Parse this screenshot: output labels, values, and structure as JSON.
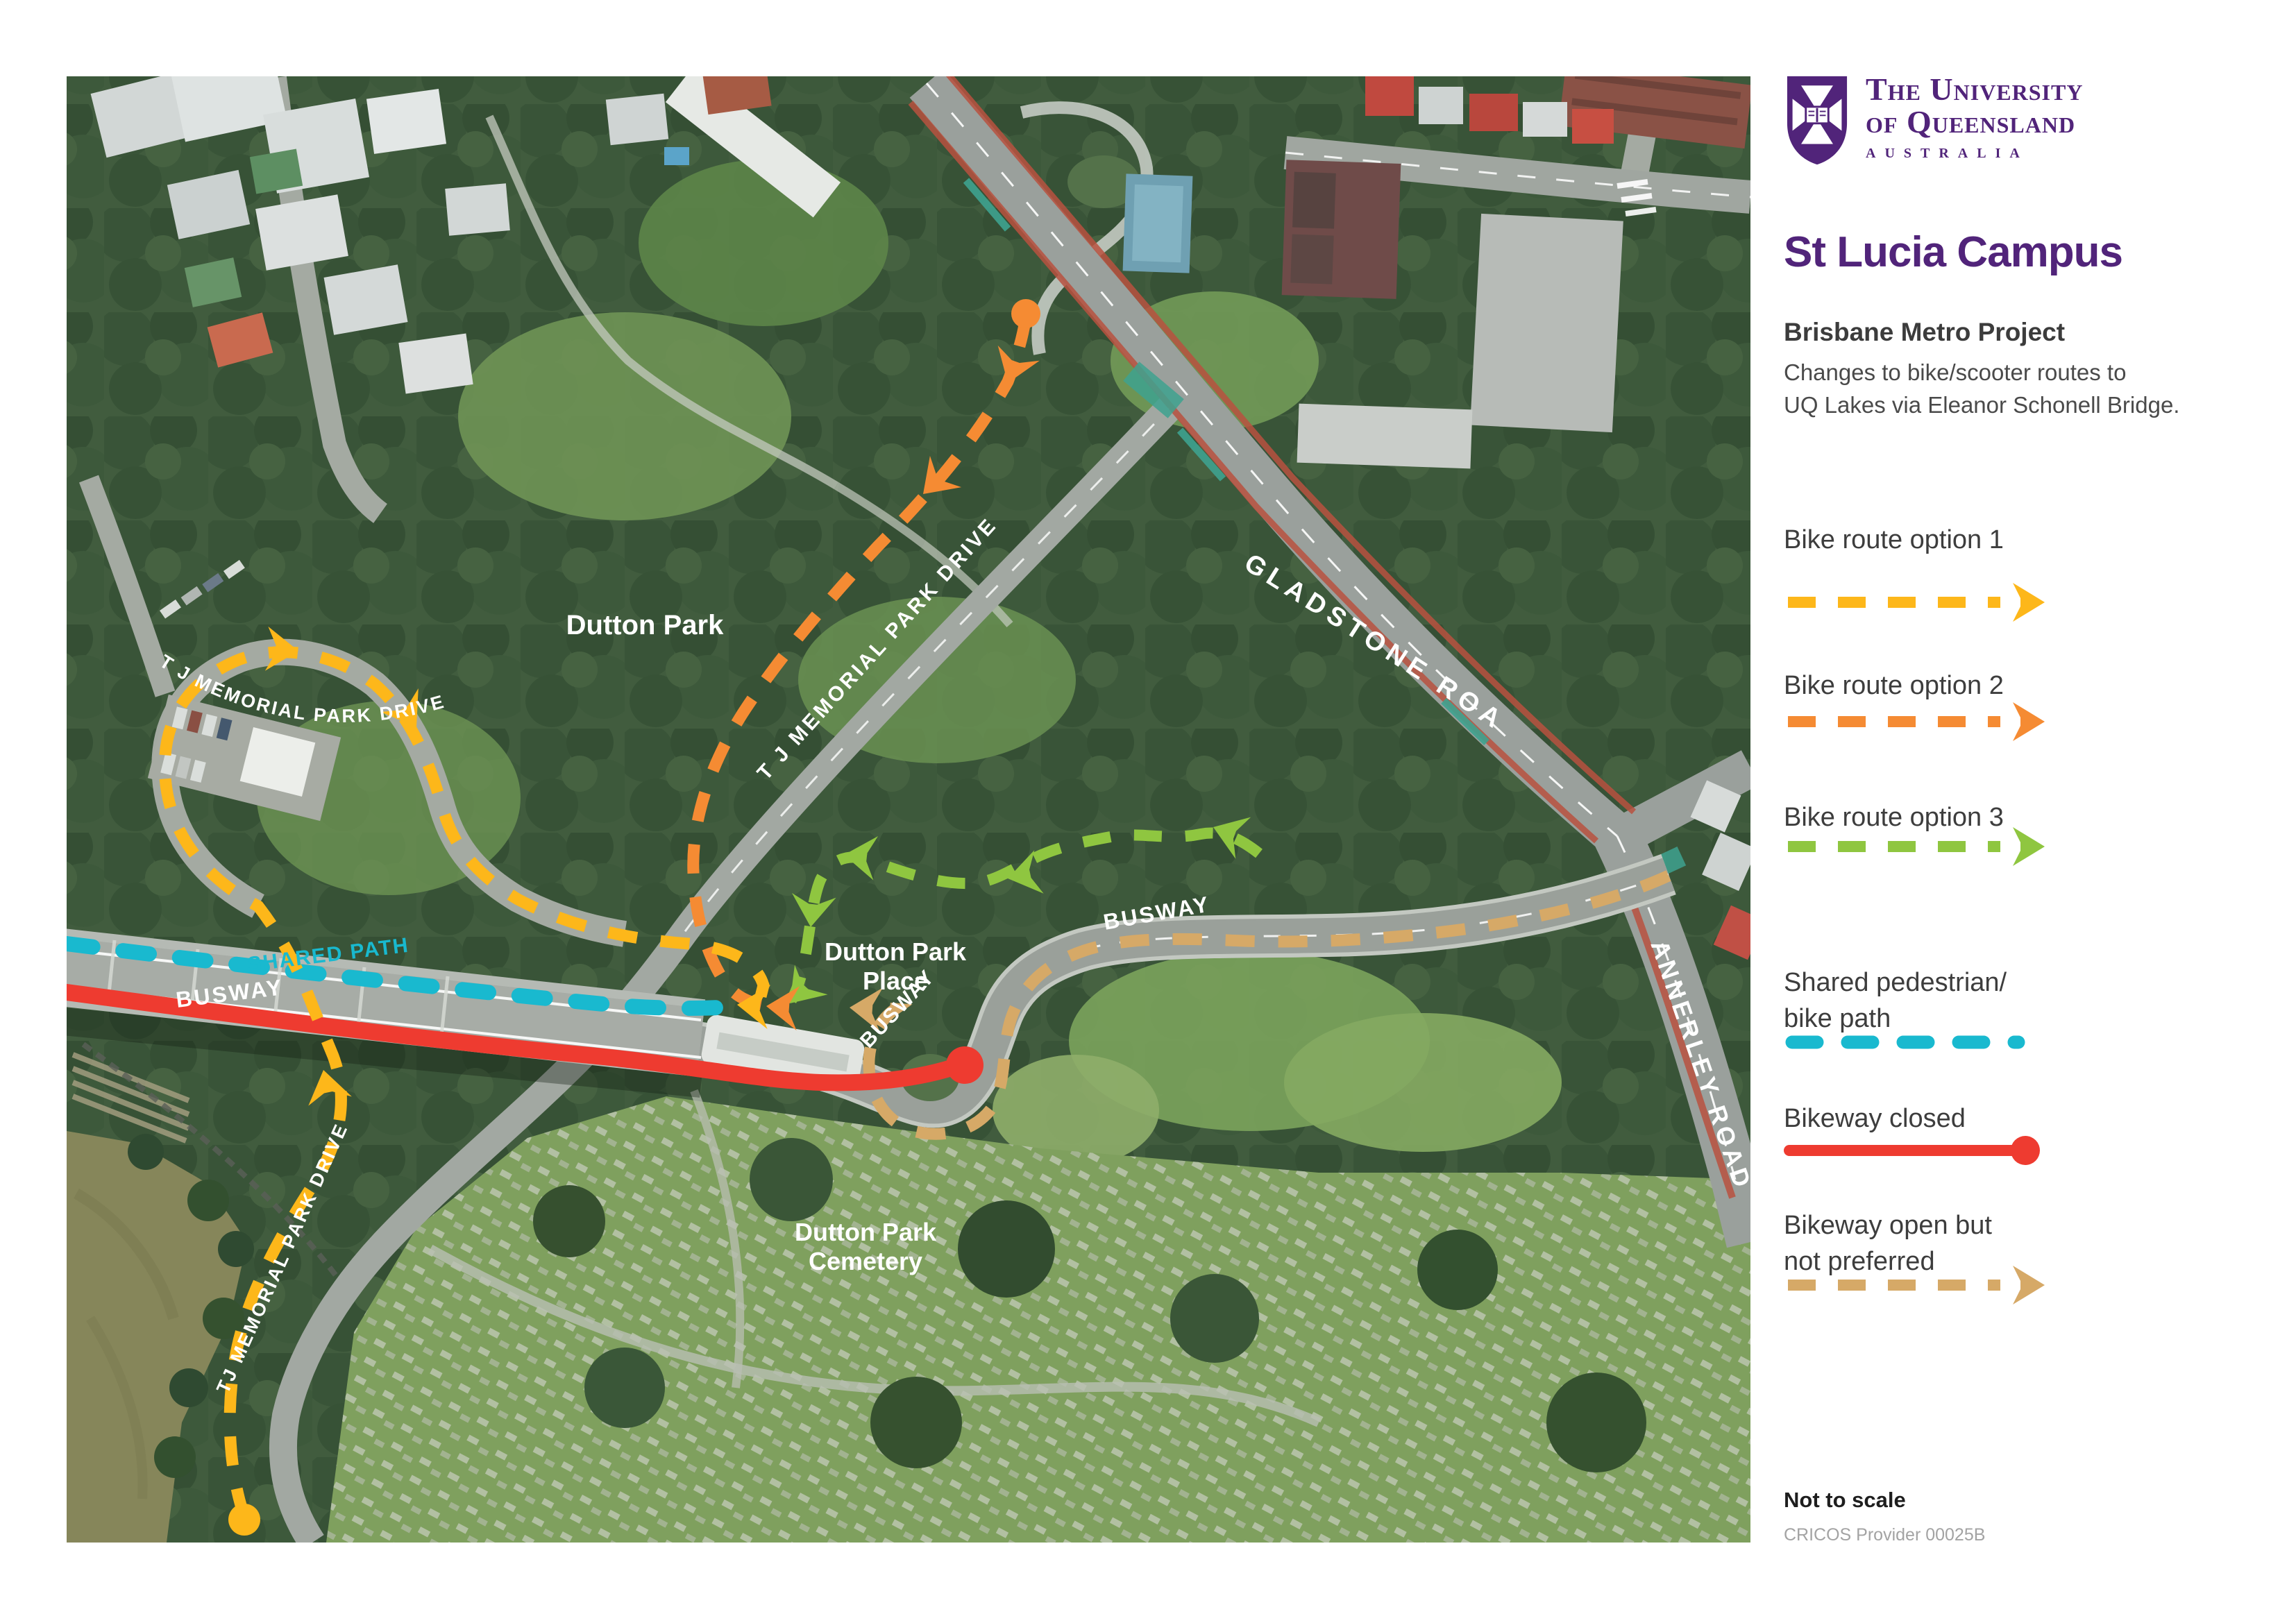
{
  "brand": {
    "university_line1": "The University",
    "university_line2": "of Queensland",
    "country": "Australia",
    "purple": "#51247A"
  },
  "sidebar": {
    "campus_title": "St Lucia Campus",
    "project_title": "Brisbane Metro Project",
    "description_line1": "Changes to bike/scooter routes to",
    "description_line2": "UQ Lakes via Eleanor Schonell Bridge.",
    "legend": [
      {
        "label": "Bike route option 1",
        "color": "#FDB71A",
        "style": "dashed-arrow"
      },
      {
        "label": "Bike route option 2",
        "color": "#F58B33",
        "style": "dashed-arrow"
      },
      {
        "label": "Bike route option 3",
        "color": "#8FC640",
        "style": "dashed-arrow"
      },
      {
        "label": "Shared pedestrian/",
        "label_line2": "bike path",
        "color": "#19B9CF",
        "style": "rounded-dashes"
      },
      {
        "label": "Bikeway closed",
        "color": "#EE3B30",
        "style": "solid-line-dot"
      },
      {
        "label": "Bikeway open but",
        "label_line2": "not preferred",
        "color": "#D6A967",
        "style": "dashed-arrow"
      }
    ],
    "scale_note": "Not to scale",
    "cricos": "CRICOS Provider 00025B"
  },
  "map": {
    "labels": {
      "dutton_park": "Dutton Park",
      "tj_memorial_loop": "T J MEMORIAL PARK DRIVE",
      "tj_memorial_drive": "T J MEMORIAL PARK DRIVE",
      "tj_memorial_south": "TJ MEMORIAL PARK DRIVE",
      "gladstone_road": "GLADSTONE ROAD",
      "annerley_road": "ANNERLEY ROAD",
      "busway": "BUSWAY",
      "shared_path": "SHARED PATH",
      "dutton_park_place_line1": "Dutton Park",
      "dutton_park_place_line2": "Place",
      "cemetery_line1": "Dutton Park",
      "cemetery_line2": "Cemetery"
    },
    "routes": {
      "option1": {
        "name": "Bike route option 1",
        "color": "#FDB71A"
      },
      "option2": {
        "name": "Bike route option 2",
        "color": "#F58B33"
      },
      "option3": {
        "name": "Bike route option 3",
        "color": "#8FC640"
      },
      "shared_path": {
        "name": "Shared pedestrian/bike path",
        "color": "#19B9CF"
      },
      "bikeway_closed": {
        "name": "Bikeway closed",
        "color": "#EE3B30"
      },
      "bikeway_open_not_preferred": {
        "name": "Bikeway open but not preferred",
        "color": "#D6A967"
      }
    }
  }
}
